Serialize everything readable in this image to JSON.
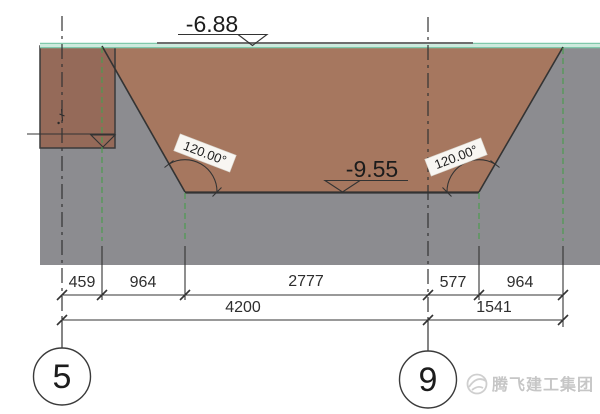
{
  "elevation_markers": {
    "ground": "-6.88",
    "pit_bottom": "-9.55"
  },
  "slope_angles": {
    "left": "120.00°",
    "right": "120.00°"
  },
  "dimensions": {
    "row1": [
      "459",
      "964",
      "2777",
      "577",
      "964"
    ],
    "row2": [
      "4200",
      "1541"
    ]
  },
  "grid_axes": {
    "left": "5",
    "right": "9"
  },
  "watermark": {
    "text": "腾飞建工集团"
  },
  "colors": {
    "soil": "#8c8c90",
    "excavation": "#a6775f",
    "pit_box": "#956a59",
    "ground_band": "#cdeadd",
    "ground_edge": "#7fc9ab",
    "top_line_gray": "#6e6e6e",
    "green_dash": "#4d9b50",
    "ink": "#333333",
    "chip_bg": "#f8f6f2",
    "watermark_gray": "#c9c9c9"
  }
}
